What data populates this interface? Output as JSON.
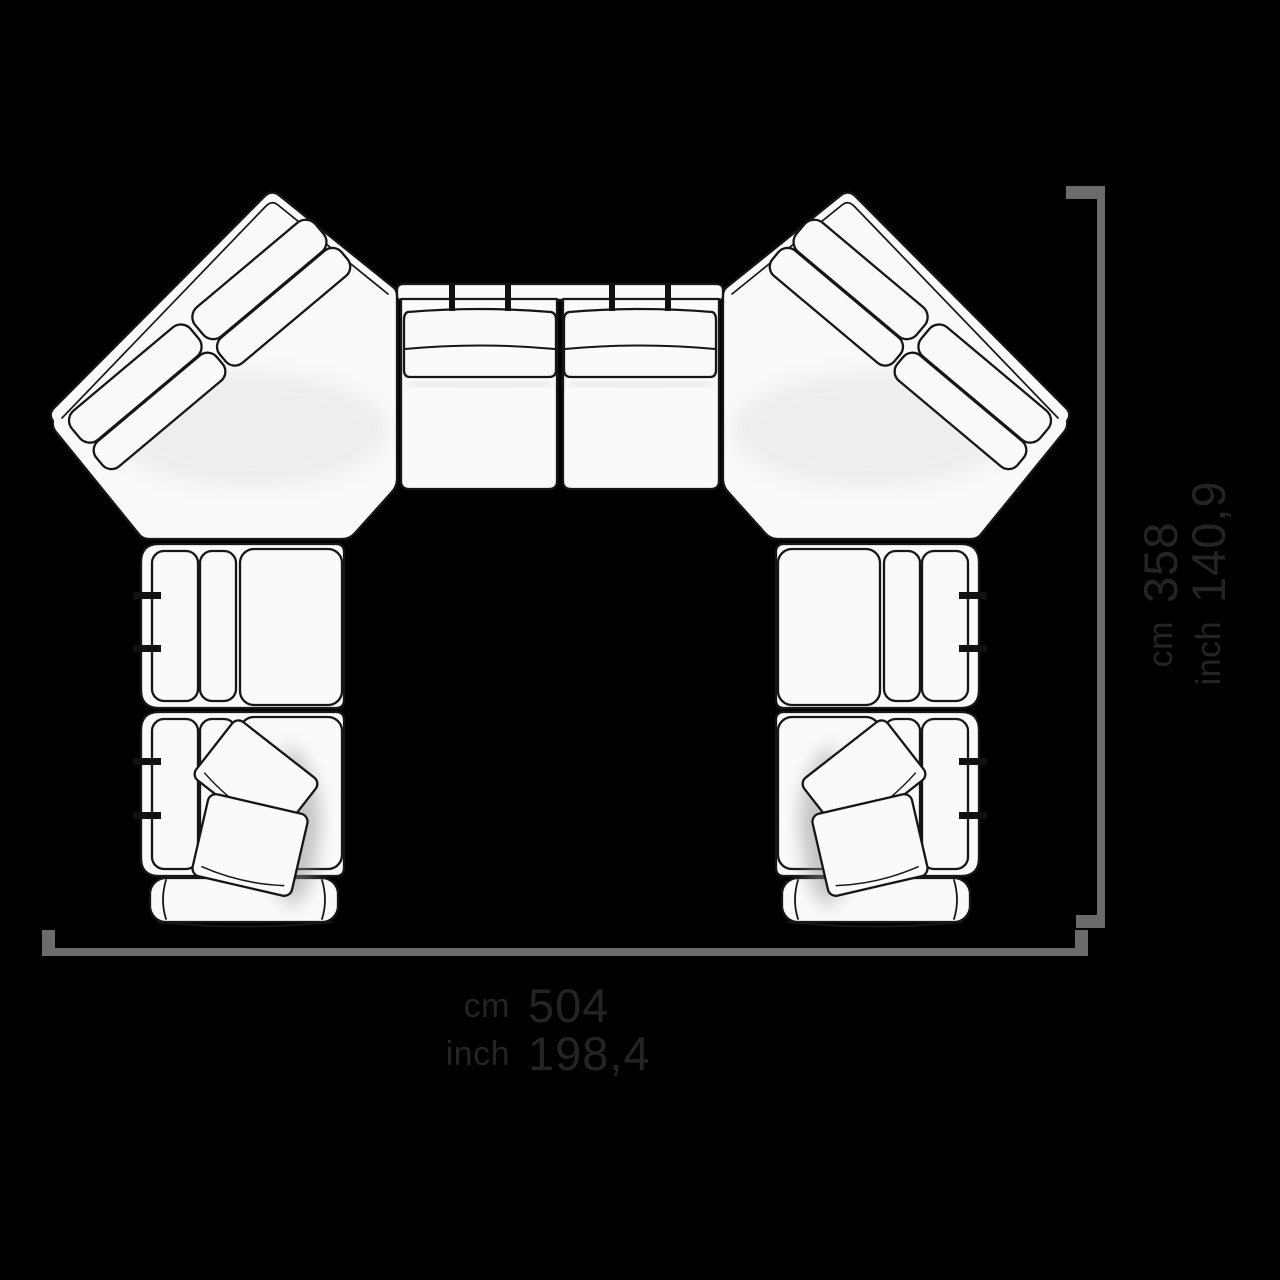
{
  "canvas": {
    "background": "#000000"
  },
  "drawing": {
    "name": "modular-sofa-top-view",
    "style": "hand-drawn black line art on white fills, plan view",
    "line_color": "#161616",
    "fill_color": "#fafafa",
    "modules": {
      "corner_left": "diagonal corner module with two split backrest cushions",
      "corner_right": "diagonal corner module with two split backrest cushions (mirrored)",
      "center": "two straight seat modules with banded backrests and four connector ticks",
      "left_arm": "two seat modules with side backrest strips, four connector ticks, two throw pillows, end armrest",
      "right_arm": "two seat modules with side backrest strips, four connector ticks, two throw pillows, end armrest (mirrored)"
    }
  },
  "dimensions": {
    "line_color": "#6b6b6b",
    "text_color": "#242424",
    "width": {
      "unit_cm": "cm",
      "value_cm": "504",
      "unit_inch": "inch",
      "value_inch": "198,4"
    },
    "depth": {
      "unit_cm": "cm",
      "value_cm": "358",
      "unit_inch": "inch",
      "value_inch": "140,9"
    }
  }
}
